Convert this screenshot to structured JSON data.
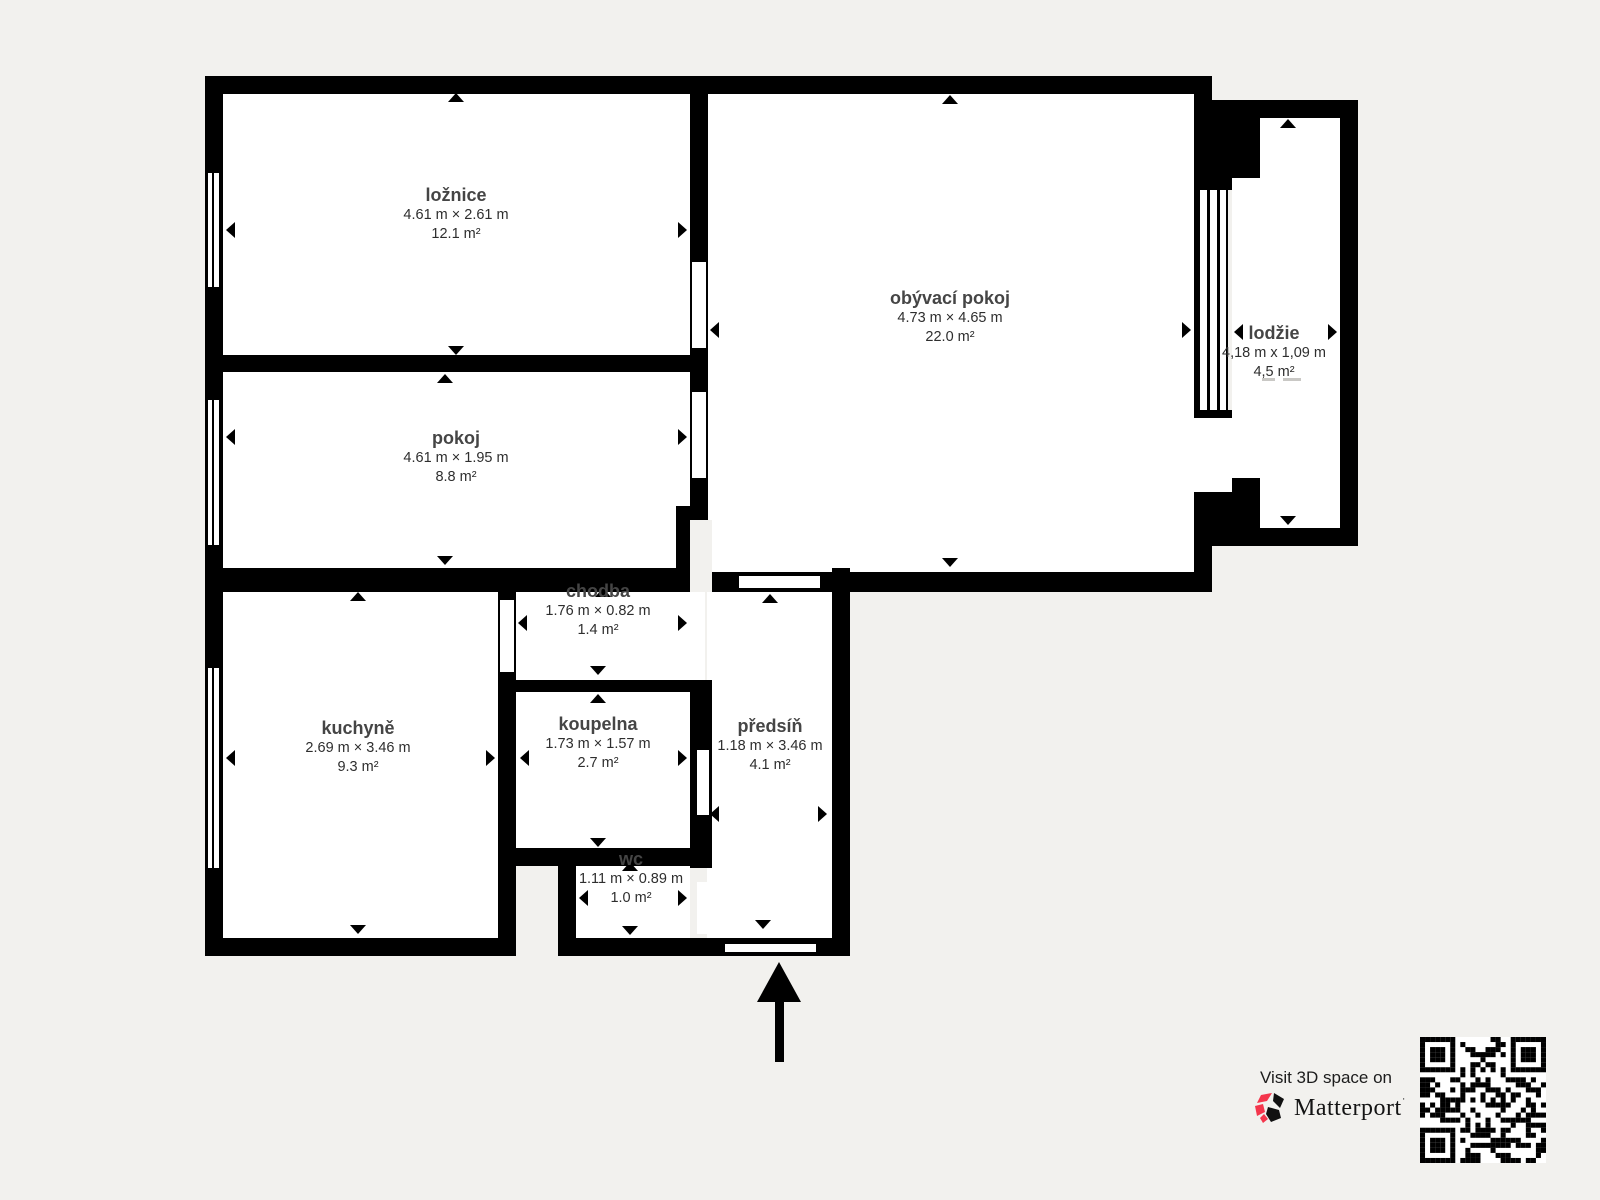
{
  "floorplan": {
    "rooms": [
      {
        "name": "ložnice",
        "dims": "4.61 m × 2.61 m",
        "area": "12.1 m²"
      },
      {
        "name": "pokoj",
        "dims": "4.61 m × 1.95 m",
        "area": "8.8 m²"
      },
      {
        "name": "obývací pokoj",
        "dims": "4.73 m × 4.65 m",
        "area": "22.0 m²"
      },
      {
        "name": "lodžie",
        "dims": "4,18 m x 1,09 m",
        "area": "4,5 m²"
      },
      {
        "name": "chodba",
        "dims": "1.76 m × 0.82 m",
        "area": "1.4 m²"
      },
      {
        "name": "kuchyně",
        "dims": "2.69 m × 3.46 m",
        "area": "9.3 m²"
      },
      {
        "name": "koupelna",
        "dims": "1.73 m × 1.57 m",
        "area": "2.7 m²"
      },
      {
        "name": "předsíň",
        "dims": "1.18 m × 3.46 m",
        "area": "4.1 m²"
      },
      {
        "name": "wc",
        "dims": "1.11 m × 0.89 m",
        "area": "1.0 m²"
      }
    ]
  },
  "footer": {
    "visit_text": "Visit 3D space on",
    "brand": "Matterport",
    "brand_tm": "˙"
  },
  "colors": {
    "background": "#f2f1ee",
    "wall": "#000000",
    "room_fill": "#ffffff",
    "brand_pink": "#f4364c"
  }
}
